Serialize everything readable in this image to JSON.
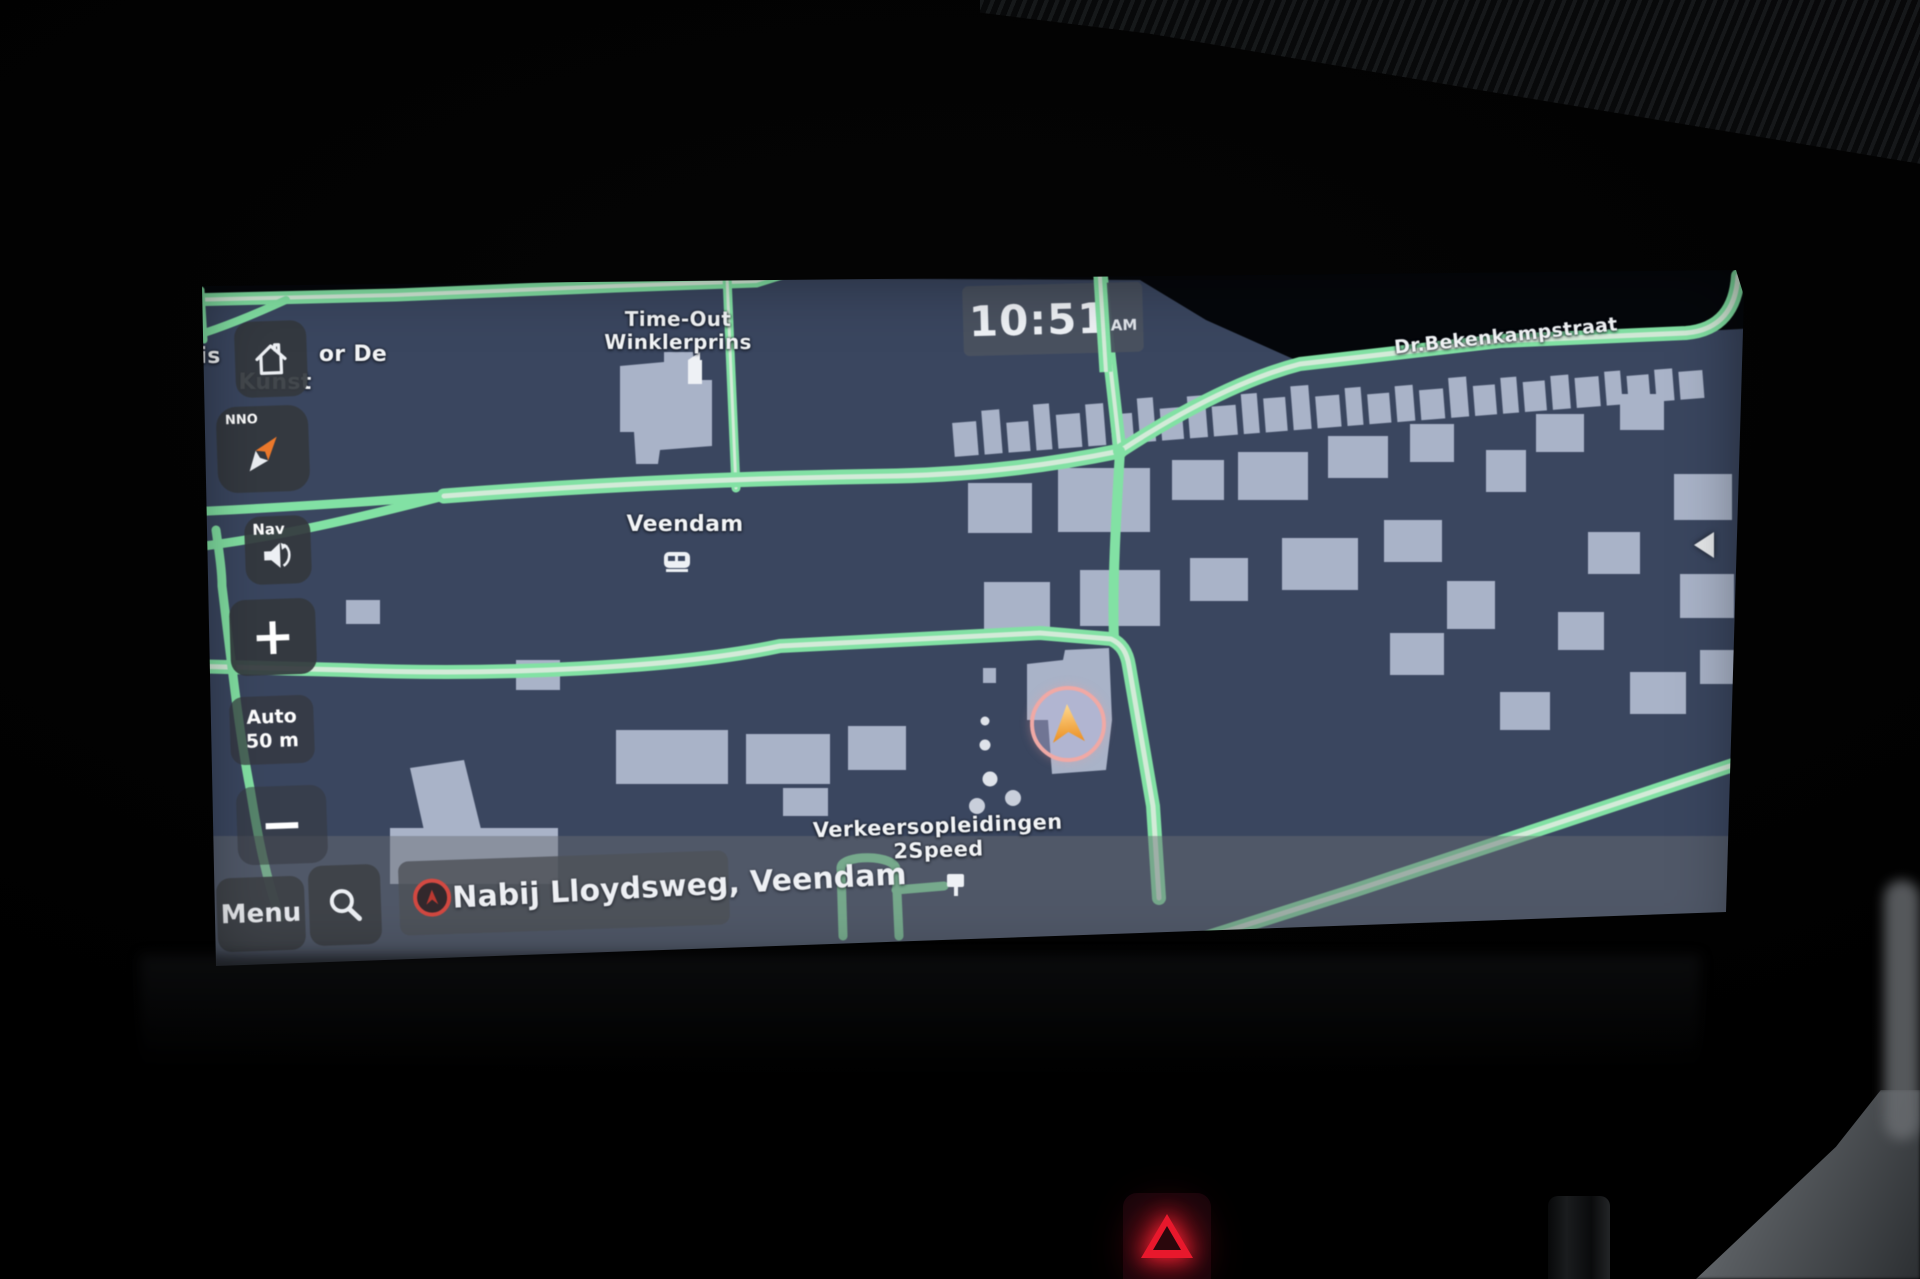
{
  "clock": {
    "time": "10:51",
    "meridiem": "AM"
  },
  "side": {
    "compass_heading": "NNO",
    "nav_label": "Nav",
    "zoom_in": "+",
    "zoom_out": "−",
    "scale_line1": "Auto",
    "scale_line2": "50 m"
  },
  "bottom": {
    "menu_label": "Menu",
    "location_text": "Nabij Lloydsweg, Veendam"
  },
  "map": {
    "city_label": "Veendam",
    "street_label": "Dr.Bekenkampstraat",
    "poi_timeout_1": "Time-Out",
    "poi_timeout_2": "Winklerprins",
    "poi_verkeer_1": "Verkeersopleidingen",
    "poi_verkeer_2": "2Speed",
    "kunst_left": "is",
    "kunst_right": "or De",
    "kunst_line2": "Kunst"
  },
  "colors": {
    "map_bg": "#3a4660",
    "map_void": "#05070b",
    "road": "#7fe2a2",
    "road_center": "#d2ebd8",
    "building": "#a9b3c9",
    "clock_bg": "#4a5260",
    "marker_ring": "#f2a8a4",
    "marker_arrow": "#ef8f1c",
    "accent_red": "#d84840"
  }
}
